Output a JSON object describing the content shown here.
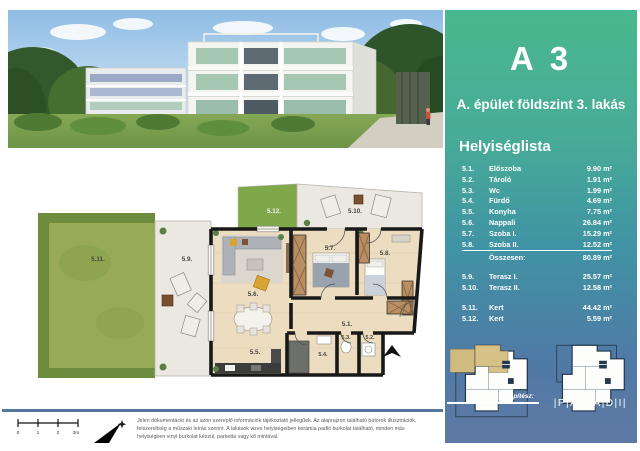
{
  "sidebar": {
    "title": "A 3",
    "subtitle": "A. épület földszint 3. lakás",
    "list_heading": "Helyiséglista",
    "rooms": [
      {
        "num": "5.1.",
        "name": "Előszoba",
        "area": "9.90 m²"
      },
      {
        "num": "5.2.",
        "name": "Tároló",
        "area": "1.91 m²"
      },
      {
        "num": "5.3.",
        "name": "Wc",
        "area": "1.99 m²"
      },
      {
        "num": "5.4.",
        "name": "Fürdő",
        "area": "4.69 m²"
      },
      {
        "num": "5.5.",
        "name": "Konyha",
        "area": "7.75 m²"
      },
      {
        "num": "5.6.",
        "name": "Nappali",
        "area": "26.84 m²"
      },
      {
        "num": "5.7.",
        "name": "Szoba I.",
        "area": "15.29 m²"
      },
      {
        "num": "5.8.",
        "name": "Szoba II.",
        "area": "12.52 m²",
        "underline": true
      }
    ],
    "total_label": "Összesen:",
    "total_area": "80.89 m²",
    "terraces": [
      {
        "num": "5.9.",
        "name": "Terasz I.",
        "area": "25.57 m²"
      },
      {
        "num": "5.10.",
        "name": "Terasz II.",
        "area": "12.58 m²"
      }
    ],
    "gardens": [
      {
        "num": "5.11.",
        "name": "Kert",
        "area": "44.42 m²"
      },
      {
        "num": "5.12.",
        "name": "Kert",
        "area": "5.59 m²"
      }
    ],
    "architect_label": "Építész:",
    "architect_name": "|P|A|L|A|D|I|"
  },
  "plan": {
    "labels": {
      "r51": "5.1.",
      "r52": "5.2.",
      "r53": "5.3.",
      "r54": "5.4.",
      "r55": "5.5.",
      "r56": "5.6.",
      "r57": "5.7.",
      "r58": "5.8.",
      "r59": "5.9.",
      "r510": "5.10.",
      "r511": "5.11.",
      "r512": "5.12."
    }
  },
  "footer": {
    "scale_ticks": [
      "0",
      "1",
      "2",
      "3m"
    ],
    "disclaimer": "Jelen dokumentáció és az azon szereplő információk tájékoztató jellegűek. Az alaprajzon található bútorok illusztrációk, felszereltség a műszaki leírás szerint. A lakások vizes helyiségeiben kerámia padló burkolat található, minden más helyiségben vinyl burkolat készül, parketta vagy kő mintával."
  },
  "colors": {
    "sidebar_green": "#4ab88e",
    "sidebar_blue": "#5e7aa4",
    "divider": "#54779f",
    "garden": "#97ab57",
    "hedge": "#6e8c3e",
    "terrace": "#eae8e1",
    "interior": "#ecdcc0",
    "wall": "#191919",
    "wardrobe": "#b98e63",
    "accent_yellow": "#d9a430"
  }
}
